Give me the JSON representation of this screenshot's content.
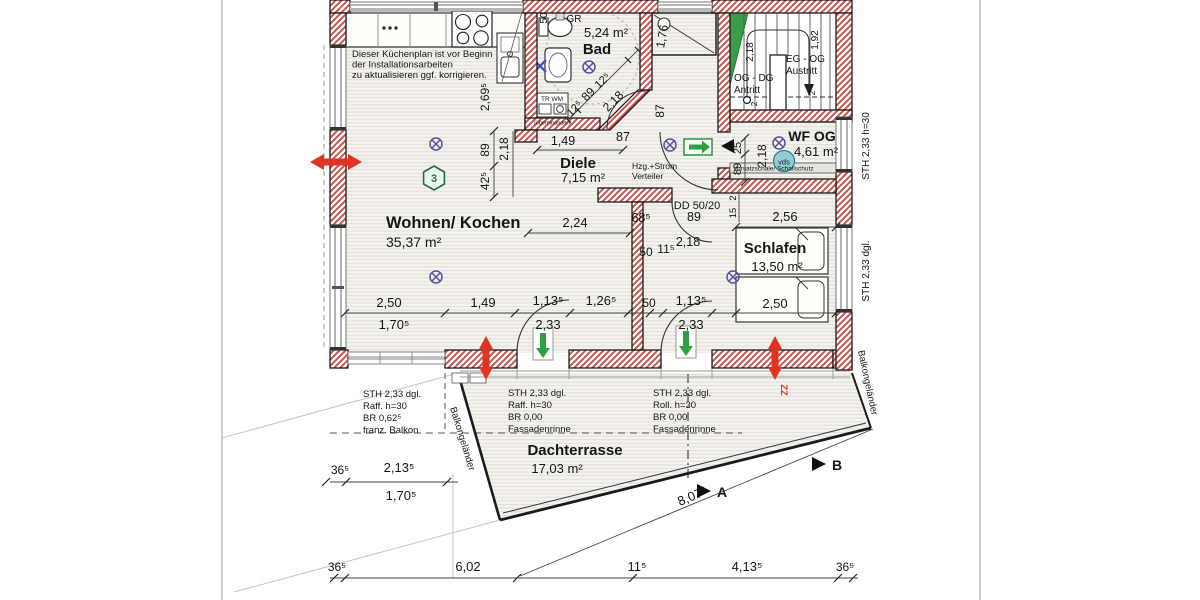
{
  "watermark": {
    "letter": "B",
    "line1": "BIRICH",
    "line2": "IMMOBILIEN"
  },
  "kitchen_note": {
    "l1": "Dieser Küchenplan ist vor Beginn",
    "l2": "der Installationsarbeiten",
    "l3": "zu aktualisieren ggf. korrigieren."
  },
  "rooms": {
    "wohnen": {
      "name": "Wohnen/ Kochen",
      "area": "35,37 m²"
    },
    "bad": {
      "name": "Bad",
      "area": "5,24 m²"
    },
    "diele": {
      "name": "Diele",
      "area": "7,15 m²"
    },
    "schlafen": {
      "name": "Schlafen",
      "area": "13,50 m²"
    },
    "wf": {
      "name": "WF OG",
      "area": "4,61 m²"
    },
    "terrasse": {
      "name": "Dachterrasse",
      "area": "17,03 m²"
    }
  },
  "stairs": {
    "og_dg": "OG - DG",
    "antritt": "Antritt",
    "eg_og": "EG - OG",
    "austritt": "Austritt",
    "h218": "2,18",
    "h192": "1,92",
    "t2a": "2",
    "t2b": "2"
  },
  "labels": {
    "hzg": "Hzg.+Strom",
    "verteiler": "Verteiler",
    "vds": "vds",
    "vorsatzschale": "Vorsatzschale/ Schallschutz",
    "sth_h30": "STH 2,33 h=30",
    "sth_dgl": "STH 2,33 dgl.",
    "balkon_l": "Balkongeländer",
    "balkon_r": "Balkongeländer",
    "dd": "DD 50/20",
    "gr": "GR",
    "trwm": "TR  WM",
    "uebereinander": "(übereinander)",
    "hex": "3",
    "zz": "ZZ",
    "sec_a": "A",
    "sec_b": "B"
  },
  "balcony_note": {
    "l1": "STH 2,33 dgl.",
    "l2": "Raff. h=30",
    "l3": "BR 0,62⁵",
    "l4": "franz. Balkon"
  },
  "terrace_note_left": {
    "l1": "STH 2,33 dgl.",
    "l2": "Raff. h=30",
    "l3": "BR 0,00",
    "l4": "Fassadenrinne"
  },
  "terrace_note_right": {
    "l1": "STH 2,33 dgl.",
    "l2": "Roll. h=30",
    "l3": "BR 0,00",
    "l4": "Fassadenrinne"
  },
  "dims": {
    "k269": "2,69⁵",
    "k89": "89",
    "k218": "2,18",
    "k425": "42⁵",
    "bad125a": "12⁵",
    "bad89": "89",
    "bad125b": "12⁵",
    "bad218": "2,18",
    "bad87": "87",
    "bad50": "50",
    "d176": "1,76",
    "diele149": "1,49",
    "diele87": "87",
    "w224": "2,24",
    "row250a": "2,50",
    "row170": "1,70⁵",
    "row149": "1,49",
    "row113a": "1,13⁵",
    "row233a": "2,33",
    "row126": "1,26⁵",
    "row50": "50",
    "row113b": "1,13⁵",
    "row233b": "2,33",
    "row250b": "2,50",
    "s256": "2,56",
    "s218": "2,18",
    "s50": "50",
    "s115": "11⁵",
    "s685": "68⁵",
    "s89": "89",
    "s15": "15",
    "s2": "2",
    "wf218": "2,18",
    "wf25": "25",
    "wf89": "89",
    "bl365": "36⁵",
    "bl2135": "2,13⁵",
    "bl1705": "1,70⁵",
    "b365a": "36⁵",
    "b602": "6,02",
    "b115": "11⁵",
    "b4135": "4,13⁵",
    "b365b": "36⁵",
    "b807": "8,07⁵"
  }
}
